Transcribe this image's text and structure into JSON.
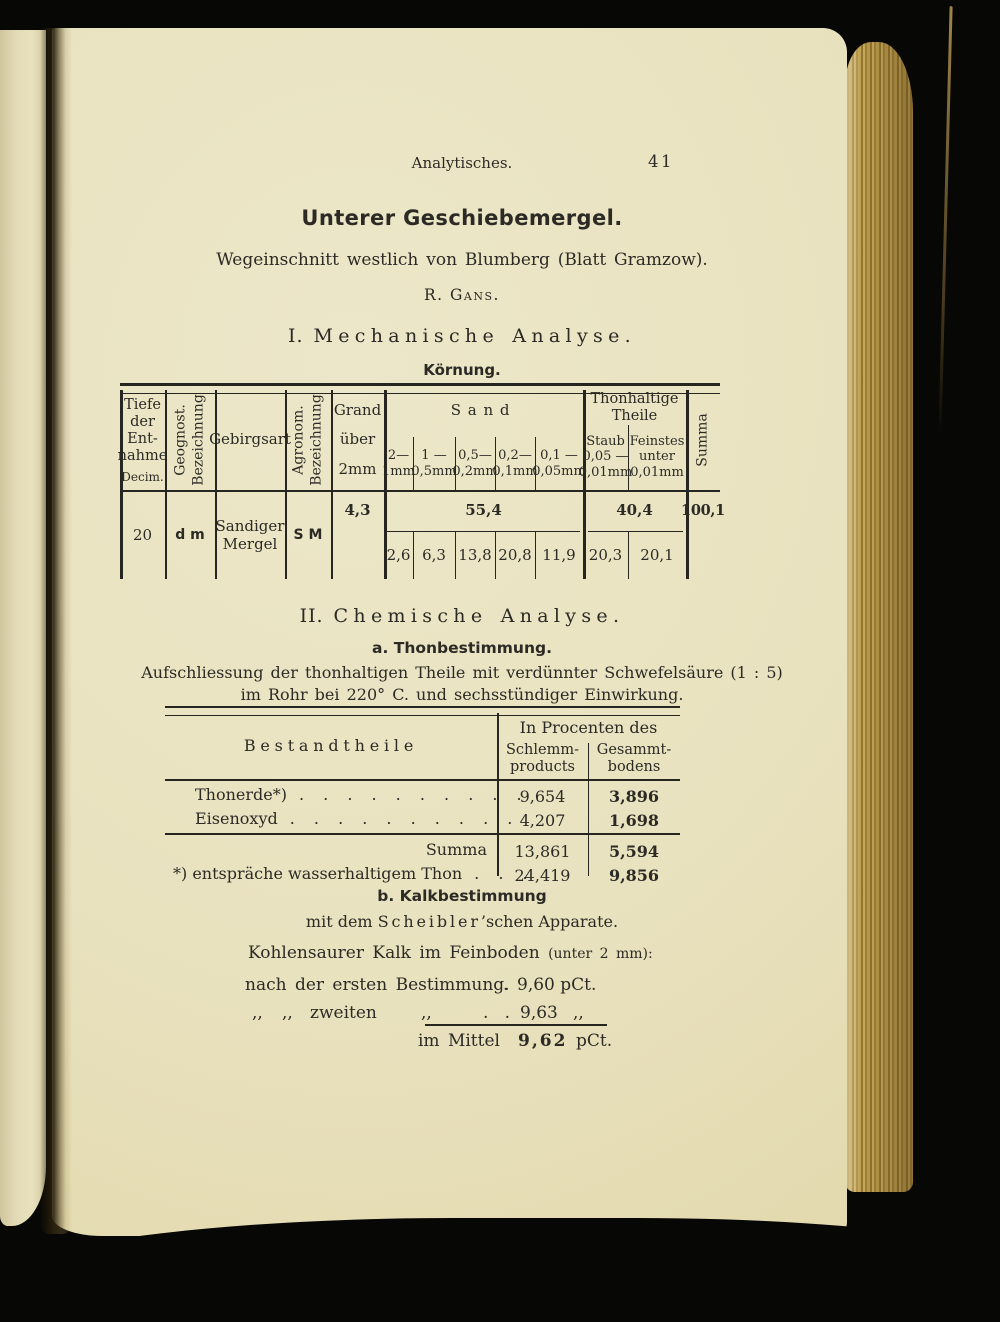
{
  "page_header": {
    "running_title": "Analytisches.",
    "page_number": "41"
  },
  "title_block": {
    "title": "Unterer Geschiebemergel.",
    "subtitle": "Wegeinschnitt westlich von Blumberg (Blatt Gramzow).",
    "author": "R. Gans."
  },
  "section1": {
    "number": "I.",
    "heading": "Mechanische Analyse.",
    "subheading": "Körnung.",
    "table": {
      "headers": {
        "tiefe": [
          "Tiefe",
          "der",
          "Ent-",
          "nahme"
        ],
        "tiefe_unit": "Decim.",
        "geognost": [
          "Geognost.",
          "Bezeichnung"
        ],
        "gebirgsart": "Gebirgsart",
        "agronom": [
          "Agronom.",
          "Bezeichnung"
        ],
        "grand": [
          "Grand",
          "über",
          "2mm"
        ],
        "sand_group": "Sand",
        "sand_cols": [
          [
            "2—",
            "1mm"
          ],
          [
            "1 —",
            "0,5mm"
          ],
          [
            "0,5—",
            "0,2mm"
          ],
          [
            "0,2—",
            "0,1mm"
          ],
          [
            "0,1 —",
            "0,05mm"
          ]
        ],
        "thon_group": [
          "Thonhaltige",
          "Theile"
        ],
        "staub": [
          "Staub",
          "0,05 —",
          "0,01mm"
        ],
        "feinstes": [
          "Feinstes",
          "unter",
          "0,01mm"
        ],
        "summa": "Summa"
      },
      "row": {
        "tiefe": "20",
        "geognost": "d m",
        "gebirgsart": [
          "Sandiger",
          "Mergel"
        ],
        "agronom": "S M",
        "grand": "4,3",
        "sand_total": "55,4",
        "sand_values": [
          "2,6",
          "6,3",
          "13,8",
          "20,8",
          "11,9"
        ],
        "thon_total": "40,4",
        "thon_values": [
          "20,3",
          "20,1"
        ],
        "summa": "100,1"
      }
    }
  },
  "section2": {
    "number": "II.",
    "heading": "Chemische Analyse.",
    "sub_a": "a. Thonbestimmung.",
    "paragraph": [
      "Aufschliessung der thonhaltigen Theile mit verdünnter Schwefelsäure (1 : 5)",
      "im Rohr bei 220° C. und sechsstündiger Einwirkung."
    ],
    "table": {
      "col1_header": "Bestandtheile",
      "group_header": "In Procenten des",
      "col2_header": [
        "Schlemm-",
        "products"
      ],
      "col3_header": [
        "Gesammt-",
        "bodens"
      ],
      "rows": [
        {
          "label": "Thonerde*)",
          "dots": ". . . . . . . . . .",
          "schlemm": "9,654",
          "gesammt": "3,896"
        },
        {
          "label": "Eisenoxyd",
          "dots": ". . . . . . . . . .",
          "schlemm": "4,207",
          "gesammt": "1,698"
        },
        {
          "label": "Summa",
          "dots": "",
          "schlemm": "13,861",
          "gesammt": "5,594"
        },
        {
          "label": "*) entspräche wasserhaltigem Thon",
          "dots": ". . .",
          "schlemm": "24,419",
          "gesammt": "9,856"
        }
      ]
    }
  },
  "section_b": {
    "heading": "b. Kalkbestimmung",
    "apparatus_pre": "mit dem",
    "apparatus_name": "Scheibler",
    "apparatus_post": "’schen Apparate.",
    "intro_main": "Kohlensaurer Kalk im Feinboden",
    "intro_note": "(unter 2 mm):",
    "line1_label": "nach der ersten Bestimmung.",
    "line1_dot": ".",
    "line1_value": "9,60 pCt.",
    "line2_q1": ",,",
    "line2_q2": ",,",
    "line2_word": "zweiten",
    "line2_q3": ",,",
    "line2_dots": ".   .",
    "line2_value": "9,63",
    "line2_unit": ",,",
    "line3_label": "im Mittel",
    "line3_value": "9,62",
    "line3_unit": "pCt."
  }
}
